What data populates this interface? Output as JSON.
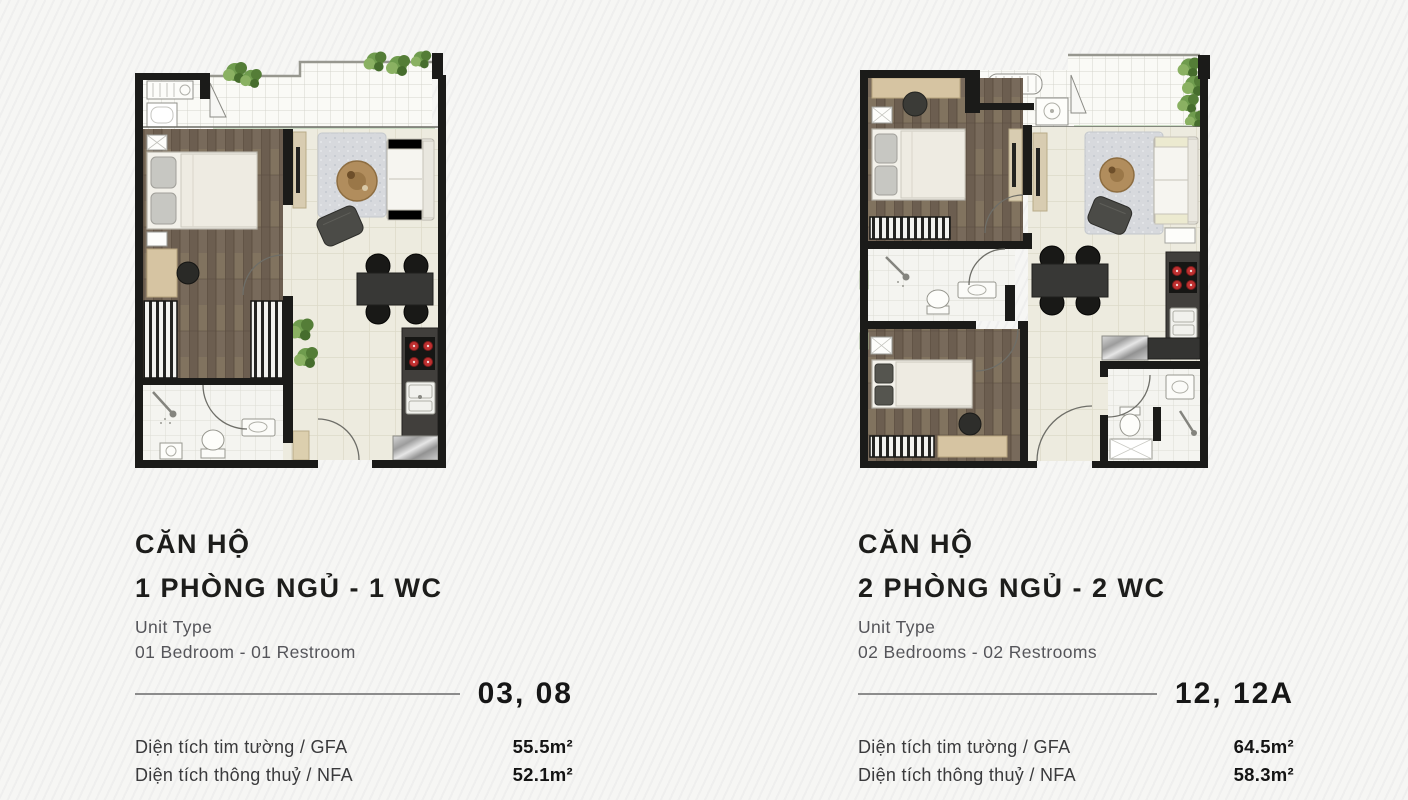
{
  "page": {
    "background": "#f6f6f4",
    "stripe_texture": "subtle-diagonal"
  },
  "colors": {
    "heading_text": "#1d1d1b",
    "secondary_text": "#55555a",
    "divider_line": "#8c8c8c",
    "wall": "#1b1b19",
    "wood_floor": "#74675a",
    "tile_floor": "#edebdf",
    "balcony_tile": "#fafaf6",
    "burner_red": "#bf3030",
    "plant_green": "#6f9c4e",
    "furniture_beige": "#d6c4a2"
  },
  "units": [
    {
      "plan_icon": "floor-plan-1-bedroom",
      "title_line1": "CĂN HỘ",
      "title_line2": "1 PHÒNG NGỦ - 1 WC",
      "unit_type_label": "Unit Type",
      "unit_type_value": "01 Bedroom - 01 Restroom",
      "unit_numbers": "03, 08",
      "areas": [
        {
          "label": "Diện tích tim tường / GFA",
          "value": "55.5m²"
        },
        {
          "label": "Diện tích thông thuỷ / NFA",
          "value": "52.1m²"
        }
      ]
    },
    {
      "plan_icon": "floor-plan-2-bedroom",
      "title_line1": "CĂN HỘ",
      "title_line2": "2 PHÒNG NGỦ - 2 WC",
      "unit_type_label": "Unit Type",
      "unit_type_value": "02 Bedrooms - 02 Restrooms",
      "unit_numbers": "12, 12A",
      "areas": [
        {
          "label": "Diện tích tim tường / GFA",
          "value": "64.5m²"
        },
        {
          "label": "Diện tích thông thuỷ / NFA",
          "value": "58.3m²"
        }
      ]
    }
  ]
}
